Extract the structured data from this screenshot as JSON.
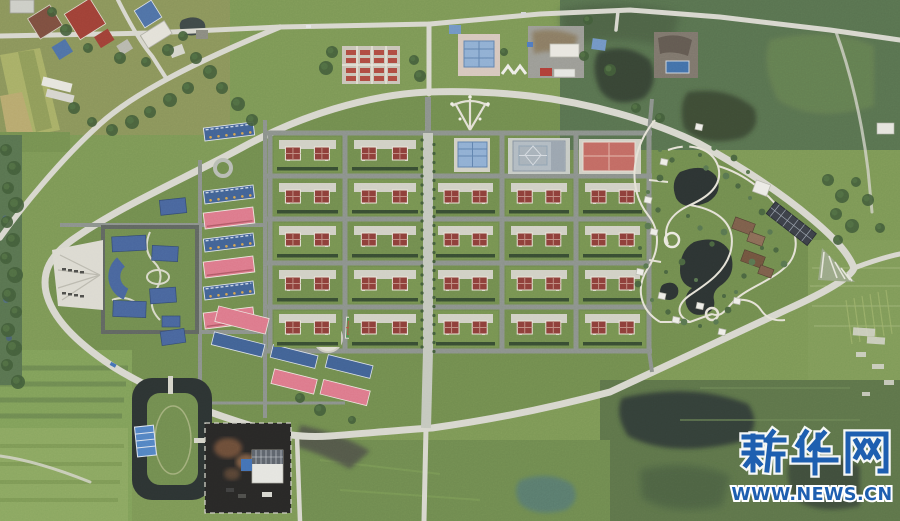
{
  "image": {
    "type": "aerial-photograph",
    "description": "Top-down drone view of a planned rural residential community: an egg-shaped ring road encloses a grid of red-roofed villa blocks, a blue-roofed school campus, rows of blue and pink apartment buildings, and a landscaped park with ponds; surrounded by farm fields, wetlands, a village at top-left, a moat pond and a fenced construction yard at bottom-left."
  },
  "watermark": {
    "site_name": "新华网",
    "url": "WWW.NEWS.CN"
  },
  "colors": {
    "grass": "#7b9751",
    "grass2": "#6f8c49",
    "meadow": "#5f7c42",
    "trees": "#3e5a33",
    "wetland": "#55704a",
    "water": "#272e2c",
    "roadRural": "#dbdacf",
    "roadGrid": "#8b918a",
    "boulevard": "#c7cabe",
    "paving": "#d3d2c6",
    "roofRed": "#8d3a33",
    "roofPink": "#e0788a",
    "aptBlue": "#3d5f93",
    "pubBlue": "#8fb0d4",
    "campusBlue": "#44639c",
    "wmBlue": "#1e5fb0"
  },
  "scene": {
    "grid": {
      "cols": [
        {
          "x": 273,
          "w": 69
        },
        {
          "x": 348,
          "w": 74
        },
        {
          "x": 432,
          "w": 67
        },
        {
          "x": 505,
          "w": 68
        },
        {
          "x": 579,
          "w": 67
        }
      ],
      "rows": [
        {
          "y": 136,
          "h": 37
        },
        {
          "y": 179,
          "h": 37
        },
        {
          "y": 222,
          "h": 38
        },
        {
          "y": 266,
          "h": 38
        },
        {
          "y": 310,
          "h": 38
        }
      ],
      "special_row0_cols": [
        2,
        3,
        4
      ],
      "houses_per_block": 2
    },
    "apartments": {
      "x": 204,
      "w": 50,
      "items": [
        {
          "y": 125,
          "kind": "blue"
        },
        {
          "y": 188,
          "kind": "blue"
        },
        {
          "y": 210,
          "kind": "pink"
        },
        {
          "y": 236,
          "kind": "blue"
        },
        {
          "y": 259,
          "kind": "pink"
        },
        {
          "y": 284,
          "kind": "blue"
        },
        {
          "y": 310,
          "kind": "pink"
        }
      ]
    },
    "boulevard_trees": {
      "x1": 422,
      "x2": 434,
      "y0": 140,
      "y1": 348,
      "step": 9
    },
    "trees": [
      [
        6,
        150,
        6
      ],
      [
        14,
        168,
        7
      ],
      [
        8,
        188,
        6
      ],
      [
        16,
        205,
        8
      ],
      [
        7,
        222,
        6
      ],
      [
        13,
        240,
        7
      ],
      [
        6,
        258,
        6
      ],
      [
        15,
        275,
        8
      ],
      [
        9,
        295,
        7
      ],
      [
        16,
        312,
        6
      ],
      [
        8,
        330,
        7
      ],
      [
        14,
        348,
        8
      ],
      [
        7,
        365,
        6
      ],
      [
        18,
        382,
        7
      ],
      [
        52,
        12,
        5
      ],
      [
        66,
        30,
        6
      ],
      [
        88,
        48,
        5
      ],
      [
        120,
        58,
        6
      ],
      [
        146,
        62,
        5
      ],
      [
        168,
        50,
        6
      ],
      [
        183,
        36,
        5
      ],
      [
        196,
        58,
        6
      ],
      [
        210,
        72,
        7
      ],
      [
        188,
        88,
        6
      ],
      [
        170,
        100,
        7
      ],
      [
        150,
        112,
        6
      ],
      [
        132,
        122,
        7
      ],
      [
        112,
        130,
        6
      ],
      [
        92,
        122,
        5
      ],
      [
        74,
        108,
        6
      ],
      [
        222,
        88,
        6
      ],
      [
        238,
        104,
        7
      ],
      [
        252,
        120,
        6
      ],
      [
        332,
        52,
        6
      ],
      [
        326,
        68,
        7
      ],
      [
        414,
        60,
        5
      ],
      [
        420,
        76,
        6
      ],
      [
        504,
        52,
        4
      ],
      [
        584,
        56,
        5
      ],
      [
        610,
        70,
        6
      ],
      [
        588,
        20,
        5
      ],
      [
        828,
        180,
        6
      ],
      [
        842,
        196,
        7
      ],
      [
        856,
        182,
        5
      ],
      [
        836,
        214,
        6
      ],
      [
        868,
        200,
        6
      ],
      [
        852,
        226,
        7
      ],
      [
        880,
        228,
        5
      ],
      [
        838,
        240,
        5
      ],
      [
        300,
        398,
        5
      ],
      [
        320,
        410,
        6
      ],
      [
        352,
        420,
        4
      ],
      [
        660,
        118,
        5
      ],
      [
        636,
        108,
        5
      ]
    ],
    "park": {
      "bushes": [
        [
          660,
          150
        ],
        [
          672,
          160
        ],
        [
          686,
          146
        ],
        [
          700,
          155
        ],
        [
          714,
          148
        ],
        [
          660,
          178
        ],
        [
          648,
          192
        ],
        [
          658,
          210
        ],
        [
          648,
          226
        ],
        [
          640,
          248
        ],
        [
          646,
          266
        ],
        [
          638,
          284
        ],
        [
          652,
          300
        ],
        [
          668,
          312
        ],
        [
          684,
          322
        ],
        [
          700,
          326
        ],
        [
          716,
          322
        ],
        [
          728,
          310
        ],
        [
          736,
          292
        ],
        [
          744,
          276
        ],
        [
          752,
          262
        ],
        [
          762,
          248
        ],
        [
          770,
          232
        ],
        [
          762,
          212
        ],
        [
          750,
          198
        ],
        [
          738,
          186
        ],
        [
          726,
          176
        ],
        [
          688,
          216
        ],
        [
          700,
          228
        ],
        [
          682,
          262
        ],
        [
          696,
          280
        ],
        [
          712,
          244
        ],
        [
          724,
          232
        ],
        [
          666,
          272
        ],
        [
          706,
          168
        ],
        [
          734,
          158
        ],
        [
          748,
          172
        ],
        [
          776,
          250
        ],
        [
          784,
          264
        ],
        [
          724,
          296
        ]
      ],
      "pavilions": [
        [
          699,
          127
        ],
        [
          664,
          162
        ],
        [
          648,
          200
        ],
        [
          654,
          232
        ],
        [
          640,
          272
        ],
        [
          662,
          296
        ],
        [
          700,
          306
        ],
        [
          676,
          320
        ],
        [
          722,
          332
        ],
        [
          737,
          301
        ]
      ]
    }
  }
}
